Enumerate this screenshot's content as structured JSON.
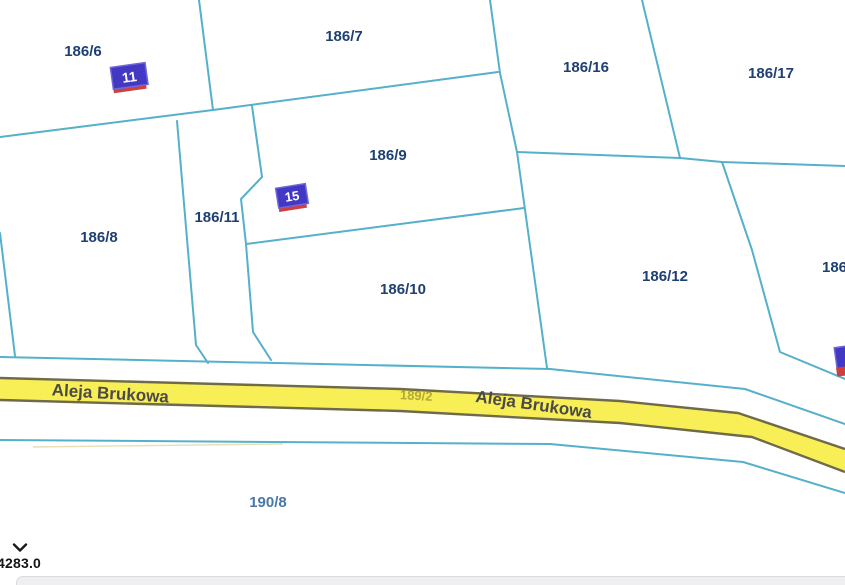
{
  "map": {
    "type": "cadastral-parcel-map",
    "parcel_labels": [
      {
        "text": "186/6"
      },
      {
        "text": "186/7"
      },
      {
        "text": "186/16"
      },
      {
        "text": "186/17"
      },
      {
        "text": "186/9"
      },
      {
        "text": "186/11"
      },
      {
        "text": "186/8"
      },
      {
        "text": "186/10"
      },
      {
        "text": "186/12"
      },
      {
        "text": "186"
      },
      {
        "text": "190/8"
      }
    ],
    "road": {
      "name": "Aleja Brukowa",
      "label_left": "Aleja Brukowa",
      "label_right": "Aleja Brukowa",
      "parcel_label": "189/2",
      "fill": "#f8ee55",
      "border": "#6e6a4a"
    },
    "building_markers": [
      {
        "label": "11"
      },
      {
        "label": "15"
      },
      {
        "label": ""
      }
    ],
    "colors": {
      "boundary_line": "#55b0cb",
      "parcel_label": "#1e3f71",
      "parcel_label_light": "#4878a8",
      "road_label": "#4a4a4a",
      "road_parcel_label": "#b3aa35",
      "marker_fill": "#4238c4",
      "marker_stripe": "#cc4040",
      "marker_text": "#ffffff"
    }
  },
  "statusbar": {
    "chevron_icon": "chevron-down",
    "coordinate_label": "4283.0"
  }
}
